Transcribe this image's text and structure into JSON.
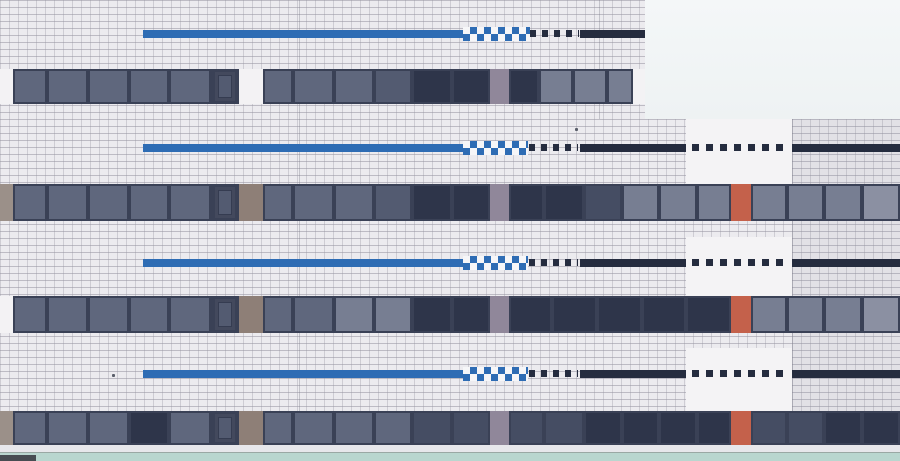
{
  "description": "Photograph of a stepped modernist building facade: white square tiling, four horizontal decorative stripes (solid blue, blue-white checkerboard, dashed black squares, solid navy), four ribbon-window bands with mauve, taupe, white and terracotta accent panels, bright sky notch at top right, pale teal ground strip at bottom",
  "colors": {
    "tile": "#ecebef",
    "grout_h": "rgba(150,148,160,0.55)",
    "grout_v": "rgba(150,148,160,0.35)",
    "sky1": "#f4f7f8",
    "sky2": "#eef2f3",
    "blue": "#2e6cb4",
    "navy": "#252c3f",
    "frame": "#3a4156",
    "g1": "#5f677d",
    "g2": "#535b71",
    "g3": "#2e354a",
    "g4": "#454d63",
    "g5": "#777e92",
    "g6": "#8b90a2",
    "mauve": "#90879a",
    "taupe": "#8e7f77",
    "orange": "#c4614b",
    "whitep": "#f3f2f4",
    "sliver": "#9b9089",
    "smooth": "#f4f3f5",
    "sill": "#e7e7eb",
    "groundline": "#9aa8a4",
    "teal": "#b9d6cf",
    "dark_obj": "#474c52",
    "seam": "rgba(120,120,135,0.35)",
    "tint": "rgba(140,142,158,0.10)",
    "speck": "#5a5e6a"
  },
  "scene": {
    "width": 900,
    "height": 461,
    "sky": {
      "x": 645,
      "y": 0,
      "w": 255,
      "h": 119
    },
    "smooth_panels": [
      {
        "x": 686,
        "y": 119,
        "w": 106,
        "h": 65
      },
      {
        "x": 686,
        "y": 237,
        "w": 106,
        "h": 59
      },
      {
        "x": 686,
        "y": 348,
        "w": 106,
        "h": 64
      }
    ],
    "tint_right": {
      "x": 792,
      "y": 119,
      "w": 108,
      "h": 326
    },
    "seams": [
      {
        "x": 299,
        "y": 0,
        "h": 445
      },
      {
        "x": 599,
        "y": 0,
        "h": 119
      },
      {
        "x": 792,
        "y": 119,
        "h": 326
      }
    ],
    "stripes": {
      "height": 8,
      "checker_height": 14,
      "rows": [
        {
          "y": 30,
          "segs": [
            [
              "blue",
              143,
              463
            ],
            [
              "checker",
              463,
              530
            ],
            [
              "dash",
              530,
              579
            ],
            [
              "solid",
              580,
              645
            ]
          ]
        },
        {
          "y": 144,
          "segs": [
            [
              "blue",
              143,
              463
            ],
            [
              "checker",
              463,
              528
            ],
            [
              "dash",
              529,
              578
            ],
            [
              "solid",
              580,
              686
            ],
            [
              "longdash",
              692,
              789
            ],
            [
              "solid",
              792,
              900
            ]
          ]
        },
        {
          "y": 259,
          "segs": [
            [
              "blue",
              143,
              463
            ],
            [
              "checker",
              463,
              528
            ],
            [
              "dash",
              529,
              578
            ],
            [
              "solid",
              580,
              686
            ],
            [
              "longdash",
              692,
              789
            ],
            [
              "solid",
              792,
              900
            ]
          ]
        },
        {
          "y": 370,
          "segs": [
            [
              "blue",
              143,
              463
            ],
            [
              "checker",
              463,
              528
            ],
            [
              "dash",
              529,
              578
            ],
            [
              "solid",
              580,
              686
            ],
            [
              "longdash",
              692,
              789
            ],
            [
              "solid",
              792,
              900
            ]
          ]
        }
      ]
    },
    "window_bands": [
      {
        "y": 69,
        "h": 35,
        "x": 0,
        "segs": [
          [
            "wall",
            13,
            "whitep"
          ],
          [
            "glass",
            34,
            "g1"
          ],
          [
            "glass",
            41,
            "g1"
          ],
          [
            "glass",
            41,
            "g1"
          ],
          [
            "glass",
            40,
            "g1"
          ],
          [
            "glass",
            42,
            "g1"
          ],
          [
            "glass",
            28,
            "g2",
            "inset"
          ],
          [
            "panel",
            24,
            "whitep"
          ],
          [
            "glass",
            30,
            "g1"
          ],
          [
            "glass",
            41,
            "g1"
          ],
          [
            "glass",
            40,
            "g1"
          ],
          [
            "glass",
            38,
            "g2"
          ],
          [
            "glass",
            40,
            "g3"
          ],
          [
            "glass",
            38,
            "g3"
          ],
          [
            "panel",
            19,
            "mauve"
          ],
          [
            "glass",
            30,
            "g3"
          ],
          [
            "glass",
            34,
            "g5"
          ],
          [
            "glass",
            34,
            "g5"
          ],
          [
            "glass",
            26,
            "g5"
          ],
          [
            "wall",
            12,
            "whitep"
          ]
        ]
      },
      {
        "y": 184,
        "h": 37,
        "x": 0,
        "segs": [
          [
            "wall",
            13,
            "sliver"
          ],
          [
            "glass",
            34,
            "g1"
          ],
          [
            "glass",
            41,
            "g1"
          ],
          [
            "glass",
            41,
            "g1"
          ],
          [
            "glass",
            40,
            "g1"
          ],
          [
            "glass",
            42,
            "g1"
          ],
          [
            "glass",
            28,
            "g2",
            "inset"
          ],
          [
            "panel",
            24,
            "taupe"
          ],
          [
            "glass",
            30,
            "g1"
          ],
          [
            "glass",
            41,
            "g1"
          ],
          [
            "glass",
            40,
            "g1"
          ],
          [
            "glass",
            38,
            "g2"
          ],
          [
            "glass",
            40,
            "g3"
          ],
          [
            "glass",
            38,
            "g3"
          ],
          [
            "panel",
            19,
            "mauve"
          ],
          [
            "glass",
            35,
            "g3"
          ],
          [
            "glass",
            40,
            "g3"
          ],
          [
            "glass",
            38,
            "g4"
          ],
          [
            "glass",
            37,
            "g5"
          ],
          [
            "glass",
            38,
            "g5"
          ],
          [
            "glass",
            34,
            "g5"
          ],
          [
            "panel",
            20,
            "orange"
          ],
          [
            "glass",
            36,
            "g5"
          ],
          [
            "glass",
            37,
            "g5"
          ],
          [
            "glass",
            38,
            "g5"
          ],
          [
            "glass",
            38,
            "g6"
          ]
        ]
      },
      {
        "y": 296,
        "h": 37,
        "x": 0,
        "segs": [
          [
            "wall",
            13,
            "whitep"
          ],
          [
            "glass",
            34,
            "g1"
          ],
          [
            "glass",
            41,
            "g1"
          ],
          [
            "glass",
            41,
            "g1"
          ],
          [
            "glass",
            40,
            "g1"
          ],
          [
            "glass",
            42,
            "g1"
          ],
          [
            "glass",
            28,
            "g2",
            "inset"
          ],
          [
            "panel",
            24,
            "taupe"
          ],
          [
            "glass",
            30,
            "g1"
          ],
          [
            "glass",
            41,
            "g1"
          ],
          [
            "glass",
            40,
            "g5"
          ],
          [
            "glass",
            38,
            "g5"
          ],
          [
            "glass",
            40,
            "g3"
          ],
          [
            "glass",
            38,
            "g3"
          ],
          [
            "panel",
            19,
            "mauve"
          ],
          [
            "glass",
            43,
            "g3"
          ],
          [
            "glass",
            45,
            "g3"
          ],
          [
            "glass",
            45,
            "g3"
          ],
          [
            "glass",
            44,
            "g3"
          ],
          [
            "glass",
            45,
            "g3"
          ],
          [
            "panel",
            20,
            "orange"
          ],
          [
            "glass",
            36,
            "g5"
          ],
          [
            "glass",
            37,
            "g5"
          ],
          [
            "glass",
            38,
            "g5"
          ],
          [
            "glass",
            38,
            "g6"
          ]
        ]
      },
      {
        "y": 411,
        "h": 34,
        "x": 0,
        "segs": [
          [
            "wall",
            13,
            "sliver"
          ],
          [
            "glass",
            34,
            "g1"
          ],
          [
            "glass",
            41,
            "g1"
          ],
          [
            "glass",
            41,
            "g1"
          ],
          [
            "glass",
            40,
            "g3"
          ],
          [
            "glass",
            42,
            "g1"
          ],
          [
            "glass",
            28,
            "g2",
            "inset"
          ],
          [
            "panel",
            24,
            "taupe"
          ],
          [
            "glass",
            30,
            "g1"
          ],
          [
            "glass",
            41,
            "g1"
          ],
          [
            "glass",
            40,
            "g1"
          ],
          [
            "glass",
            38,
            "g1"
          ],
          [
            "glass",
            40,
            "g4"
          ],
          [
            "glass",
            38,
            "g4"
          ],
          [
            "panel",
            19,
            "mauve"
          ],
          [
            "glass",
            35,
            "g4"
          ],
          [
            "glass",
            40,
            "g4"
          ],
          [
            "glass",
            38,
            "g3"
          ],
          [
            "glass",
            37,
            "g3"
          ],
          [
            "glass",
            38,
            "g3"
          ],
          [
            "glass",
            34,
            "g3"
          ],
          [
            "panel",
            20,
            "orange"
          ],
          [
            "glass",
            36,
            "g4"
          ],
          [
            "glass",
            37,
            "g4"
          ],
          [
            "glass",
            38,
            "g3"
          ],
          [
            "glass",
            38,
            "g3"
          ]
        ]
      }
    ],
    "ground": {
      "sill": {
        "y": 445,
        "h": 8
      },
      "line": {
        "y": 452,
        "h": 1
      },
      "teal": {
        "y": 453,
        "h": 8
      },
      "dark_object": {
        "x": 0,
        "y": 455,
        "w": 36,
        "h": 6
      }
    },
    "specks": [
      {
        "x": 112,
        "y": 374
      },
      {
        "x": 28,
        "y": 186
      },
      {
        "x": 575,
        "y": 128
      }
    ]
  }
}
